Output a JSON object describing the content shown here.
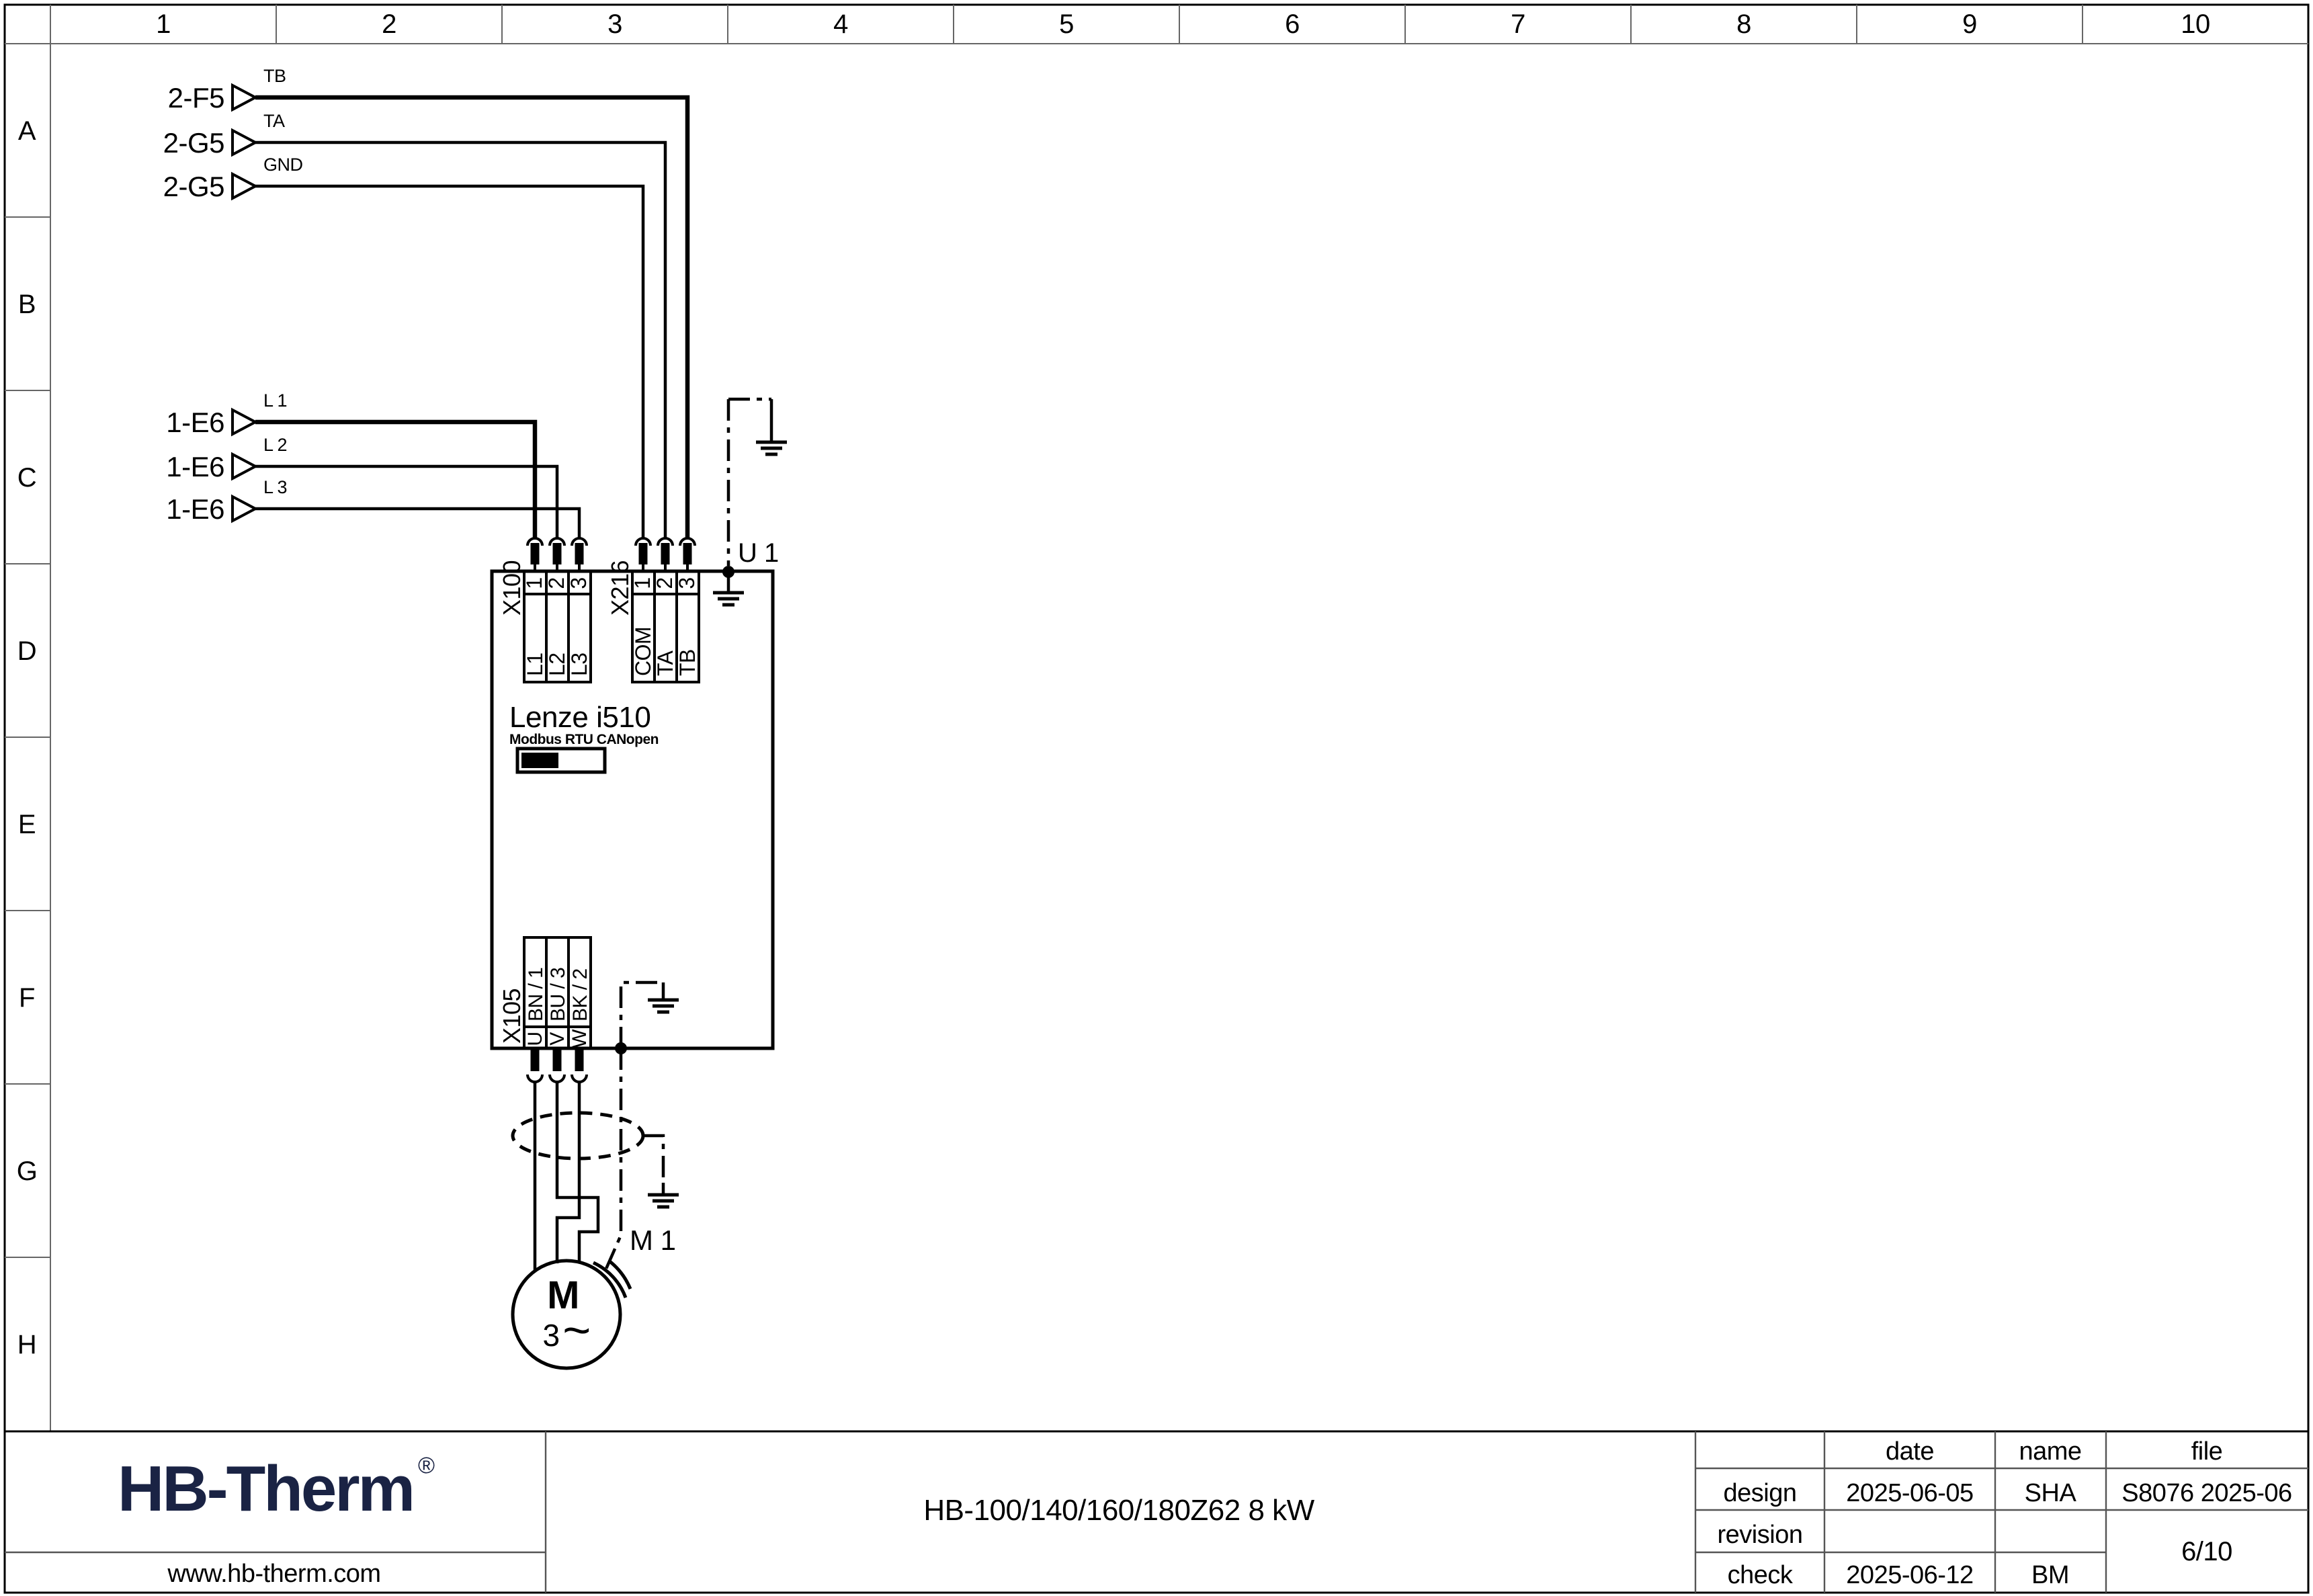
{
  "colors": {
    "line": "#000000",
    "logo_navy": "#1a2344"
  },
  "ruler": {
    "columns": [
      "1",
      "2",
      "3",
      "4",
      "5",
      "6",
      "7",
      "8",
      "9",
      "10"
    ],
    "rows": [
      "A",
      "B",
      "C",
      "D",
      "E",
      "F",
      "G",
      "H"
    ]
  },
  "schematic": {
    "sources": [
      {
        "ref": "2-F5",
        "signal": "TB"
      },
      {
        "ref": "2-G5",
        "signal": "TA"
      },
      {
        "ref": "2-G5",
        "signal": "GND"
      },
      {
        "ref": "1-E6",
        "signal": "L 1"
      },
      {
        "ref": "1-E6",
        "signal": "L 2"
      },
      {
        "ref": "1-E6",
        "signal": "L 3"
      }
    ],
    "drive": {
      "designation": "U 1",
      "model": "Lenze i510",
      "comm": "Modbus RTU CANopen",
      "x100": {
        "name": "X100",
        "pins": [
          "1",
          "2",
          "3"
        ],
        "labels": [
          "L1",
          "L2",
          "L3"
        ]
      },
      "x216": {
        "name": "X216",
        "pins": [
          "1",
          "2",
          "3"
        ],
        "labels": [
          "COM",
          "TA",
          "TB"
        ]
      },
      "x105": {
        "name": "X105",
        "pins": [
          "U",
          "V",
          "W"
        ],
        "labels": [
          "BN / 1",
          "BU / 3",
          "BK / 2"
        ]
      }
    },
    "motor": {
      "designation": "M 1",
      "letter": "M",
      "phase": "3",
      "wave": "~"
    }
  },
  "titleblock": {
    "logo": "HB-Therm",
    "logo_reg": "®",
    "website": "www.hb-therm.com",
    "title": "HB-100/140/160/180Z62 8 kW",
    "table": {
      "col_headers": [
        "date",
        "name",
        "file"
      ],
      "row_design": {
        "label": "design",
        "date": "2025-06-05",
        "name": "SHA",
        "file": "S8076 2025-06"
      },
      "row_revision": {
        "label": "revision",
        "date": "",
        "name": ""
      },
      "row_check": {
        "label": "check",
        "date": "2025-06-12",
        "name": "BM"
      },
      "page": "6/10"
    }
  }
}
